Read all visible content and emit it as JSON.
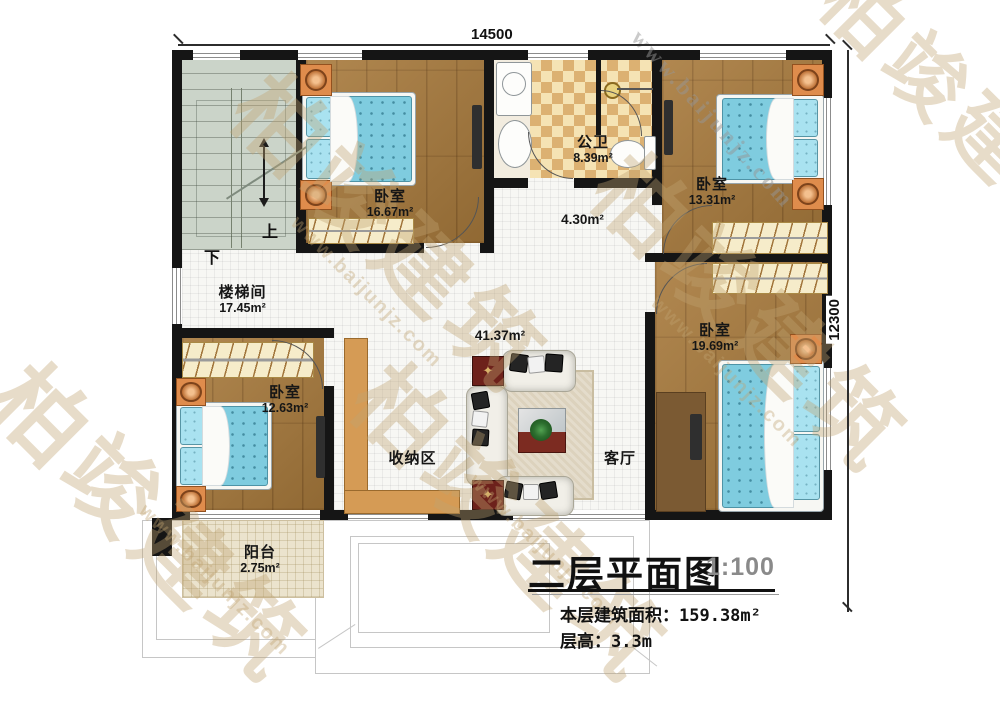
{
  "dimensions": {
    "top": "14500",
    "right": "12300"
  },
  "rooms": {
    "stairwell": {
      "name": "楼梯间",
      "area": "17.45m²",
      "up_label": "上",
      "down_label": "下"
    },
    "bedroom_top_left": {
      "name": "卧室",
      "area": "16.67m²"
    },
    "bathroom": {
      "name": "公卫",
      "area": "8.39m²"
    },
    "hallway": {
      "area": "4.30m²"
    },
    "bedroom_top_right": {
      "name": "卧室",
      "area": "13.31m²"
    },
    "bedroom_right": {
      "name": "卧室",
      "area": "19.69m²"
    },
    "living_room": {
      "name": "客厅",
      "area": "41.37m²"
    },
    "storage": {
      "name": "收纳区"
    },
    "bedroom_bottom_left": {
      "name": "卧室",
      "area": "12.63m²"
    },
    "balcony": {
      "name": "阳台",
      "area": "2.75m²"
    }
  },
  "title_block": {
    "title": "二层平面图",
    "scale": "1:100",
    "area_label": "本层建筑面积：",
    "area_value": "159.38m²",
    "height_label": "层高：",
    "height_value": "3.3m"
  },
  "watermark": {
    "brand": "柏竣建筑",
    "url": "www.baijunjz.com"
  },
  "icons": {
    "star": "✦"
  },
  "colors": {
    "wall": "#151515",
    "wood_floor": "#a87a3c",
    "bed_blue": "#7fccdf",
    "checker_tan": "#dcb172",
    "watermark_tan": "#c1a270"
  }
}
